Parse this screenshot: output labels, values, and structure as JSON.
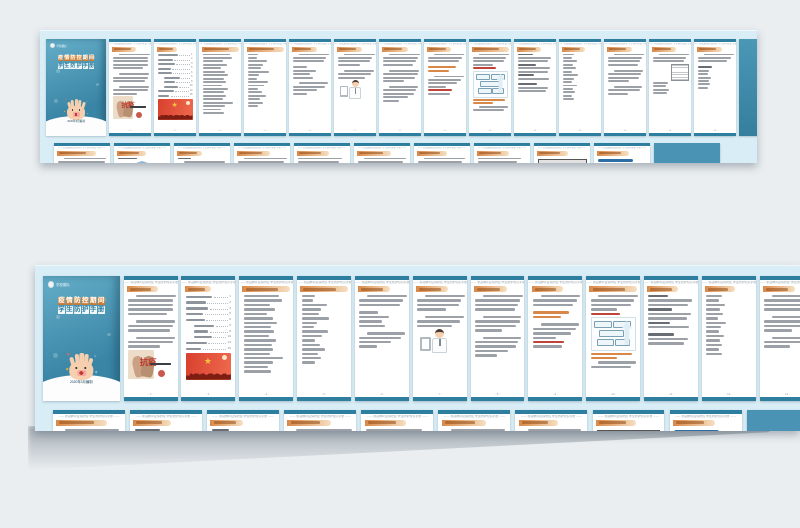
{
  "meta": {
    "description": "Preview spread of a Chinese epidemic-prevention student handbook booklet, shown as two photographed strips of pages on a grey background"
  },
  "colors": {
    "canvas_bg": "#eaeef1",
    "strip_bg": "#d9edf6",
    "page_bg": "#ffffff",
    "teal_band": "#2e7f9f",
    "cover_teal_top": "#64aec9",
    "cover_teal_bottom": "#3a84a5",
    "orange_bar_start": "#d8894a",
    "orange_bar_end": "#f6dfc0",
    "orange_bar_text": "#944b12",
    "body_line": "#9ba1a7",
    "accent_red": "#c0443a",
    "flag_red": "#d8402e",
    "gold": "#f5c23c",
    "skin": "#f6cfae",
    "building_blue": "#8fb4d2",
    "back_cover_teal": "#4b93b4"
  },
  "cover": {
    "logo_text": "学校徽标",
    "title_line1": "疫情防控期间",
    "title_line2": "学生防护手册",
    "date_line": "2020年3月编制"
  },
  "running_header": "—— 新冠肺炎疫情防控 学生防护知识手册 ——",
  "foreword_stamp": "抗疫",
  "big_text_page": {
    "text": "中国加油",
    "mark": "!"
  },
  "back_cover_word": "hope",
  "pages_row1": [
    {
      "type": "cover",
      "name": "cover"
    },
    {
      "type": "content",
      "name": "foreword",
      "hdr": 58,
      "body": [
        "i:90",
        "l:100",
        "l:100",
        "l:100",
        "l:86",
        "g",
        "i:88",
        "l:100",
        "l:94",
        "g",
        "i:86",
        "l:100",
        "l:70",
        "f:hands"
      ]
    },
    {
      "type": "toc",
      "name": "contents",
      "hdr": 48,
      "toc": [
        {
          "w": 58,
          "ind": 0,
          "num": "1"
        },
        {
          "w": 44,
          "ind": 0,
          "num": "2"
        },
        {
          "w": 50,
          "ind": 0,
          "num": "3"
        },
        {
          "w": 38,
          "ind": 0,
          "num": "5"
        },
        {
          "w": 42,
          "ind": 0,
          "num": "6"
        },
        {
          "w": 46,
          "ind": 1,
          "num": "6"
        },
        {
          "w": 32,
          "ind": 1,
          "num": "8"
        },
        {
          "w": 40,
          "ind": 1,
          "num": "10"
        },
        {
          "w": 46,
          "ind": 0,
          "num": "13"
        },
        {
          "w": 34,
          "ind": 0,
          "num": "15"
        }
      ],
      "body": [
        "toc",
        "f:flag"
      ]
    },
    {
      "type": "content",
      "name": "list-page-1",
      "hdr": 96,
      "body": [
        "l:78",
        "l:84",
        "l:58",
        "l:70",
        "l:52",
        "l:64",
        "l:74",
        "l:60",
        "l:68",
        "l:55",
        "l:72",
        "l:62",
        "l:66",
        "l:58",
        "l:88",
        "l:64",
        "l:54",
        "l:60"
      ]
    },
    {
      "type": "content",
      "name": "list-page-2",
      "hdr": 96,
      "body": [
        "l:30",
        "l:26",
        "l:56",
        "l:44",
        "l:38",
        "l:62",
        "l:34",
        "l:28",
        "l:58",
        "l:46",
        "l:30",
        "l:40",
        "l:52",
        "l:36",
        "l:44",
        "l:30"
      ]
    },
    {
      "type": "content",
      "name": "list-page-3",
      "hdr": 60,
      "body": [
        "i:88",
        "l:96",
        "l:90",
        "g",
        "l:42",
        "l:66",
        "l:50",
        "l:58",
        "g",
        "i:84",
        "l:92",
        "l:70",
        "l:40"
      ]
    },
    {
      "type": "content",
      "name": "doctor-page",
      "hdr": 60,
      "body": [
        "i:90",
        "l:98",
        "l:92",
        "l:64",
        "g",
        "i:86",
        "l:96",
        "l:78",
        "f:doctor"
      ]
    },
    {
      "type": "content",
      "name": "paragraph-page-1",
      "hdr": 62,
      "body": [
        "i:90",
        "l:100",
        "l:96",
        "l:88",
        "g",
        "i:86",
        "l:100",
        "l:92",
        "l:60",
        "g",
        "i:84",
        "l:96",
        "l:90",
        "l:74",
        "l:48"
      ]
    },
    {
      "type": "content",
      "name": "paragraph-page-2",
      "hdr": 58,
      "body": [
        "i:88",
        "l:98",
        "l:90",
        "g",
        "o:80",
        "o:62",
        "g",
        "i:86",
        "l:96",
        "l:84",
        "l:52",
        "r:70",
        "l:64"
      ]
    },
    {
      "type": "content",
      "name": "flowchart-page",
      "hdr": 96,
      "body": [
        "i:88",
        "l:96",
        "l:90",
        "l:58",
        "r:66",
        "f:chart",
        "o:92",
        "o:58",
        "i:84",
        "l:90"
      ]
    },
    {
      "type": "content",
      "name": "subhead-list-page",
      "hdr": 58,
      "body": [
        "d:44",
        "l:96",
        "l:88",
        "d:52",
        "l:94",
        "l:86",
        "d:48",
        "l:90",
        "g",
        "d:56",
        "l:88",
        "l:80"
      ]
    },
    {
      "type": "content",
      "name": "short-list-page",
      "hdr": 55,
      "body": [
        "l:34",
        "l:28",
        "l:42",
        "l:30",
        "l:38",
        "l:26",
        "l:44",
        "l:32",
        "l:28",
        "l:40",
        "l:30",
        "l:36",
        "l:28",
        "l:34"
      ]
    },
    {
      "type": "content",
      "name": "paragraph-page-3",
      "hdr": 60,
      "body": [
        "i:88",
        "l:98",
        "l:94",
        "l:86",
        "g",
        "i:84",
        "l:96",
        "l:90",
        "l:62",
        "g",
        "i:82",
        "l:94",
        "l:58"
      ]
    },
    {
      "type": "content",
      "name": "grid-page",
      "hdr": 58,
      "body": [
        "i:86",
        "l:96",
        "l:90",
        "f:grid",
        "l:44",
        "l:38",
        "l:46",
        "l:40"
      ]
    },
    {
      "type": "content",
      "name": "paragraph-page-4",
      "hdr": 60,
      "body": [
        "i:88",
        "l:96",
        "l:84",
        "g",
        "d:40",
        "l:34",
        "l:30",
        "l:38",
        "l:32",
        "l:36",
        "l:30"
      ]
    },
    {
      "type": "tealback",
      "name": "inner-teal-page"
    }
  ],
  "pages_row2": [
    {
      "type": "content",
      "name": "back-text-1",
      "hdr": 70,
      "body": [
        "i:86",
        "l:96",
        "l:90",
        "l:58",
        "d:36"
      ]
    },
    {
      "type": "content",
      "name": "building-page",
      "hdr": 52,
      "body": [
        "d:40",
        "f:building"
      ]
    },
    {
      "type": "content",
      "name": "back-text-2",
      "hdr": 46,
      "body": [
        "d:28",
        "i:84",
        "l:62"
      ]
    },
    {
      "type": "content",
      "name": "back-text-3",
      "hdr": 60,
      "body": [
        "i:88",
        "l:94",
        "l:70"
      ]
    },
    {
      "type": "content",
      "name": "back-text-4",
      "hdr": 58,
      "body": [
        "l:90",
        "l:84",
        "l:60"
      ]
    },
    {
      "type": "content",
      "name": "back-text-5",
      "hdr": 62,
      "body": [
        "i:86",
        "l:92",
        "l:54"
      ]
    },
    {
      "type": "content",
      "name": "back-text-6",
      "hdr": 54,
      "body": [
        "i:84",
        "l:90",
        "l:62"
      ]
    },
    {
      "type": "content",
      "name": "back-text-7",
      "hdr": 58,
      "body": [
        "l:88",
        "l:80",
        "l:52"
      ]
    },
    {
      "type": "content",
      "name": "form-page",
      "hdr": 56,
      "body": [
        "f:form"
      ]
    },
    {
      "type": "content",
      "name": "big-text-page",
      "hdr": 58,
      "body": [
        "f:bluebar",
        "f:bigtext"
      ]
    },
    {
      "type": "backcover",
      "name": "back-cover"
    }
  ],
  "layout": {
    "strips": [
      {
        "left": 40,
        "top": 30,
        "width": 717,
        "height": 132,
        "scale_class": "s1",
        "row2_indices": [
          0,
          1,
          2,
          3,
          4,
          5,
          6,
          7,
          8,
          9,
          10
        ]
      },
      {
        "left": 35,
        "top": 265,
        "width": 765,
        "height": 165,
        "scale_class": "s2",
        "row2_indices": [
          0,
          1,
          2,
          3,
          4,
          5,
          6,
          8,
          9,
          10
        ]
      }
    ]
  }
}
